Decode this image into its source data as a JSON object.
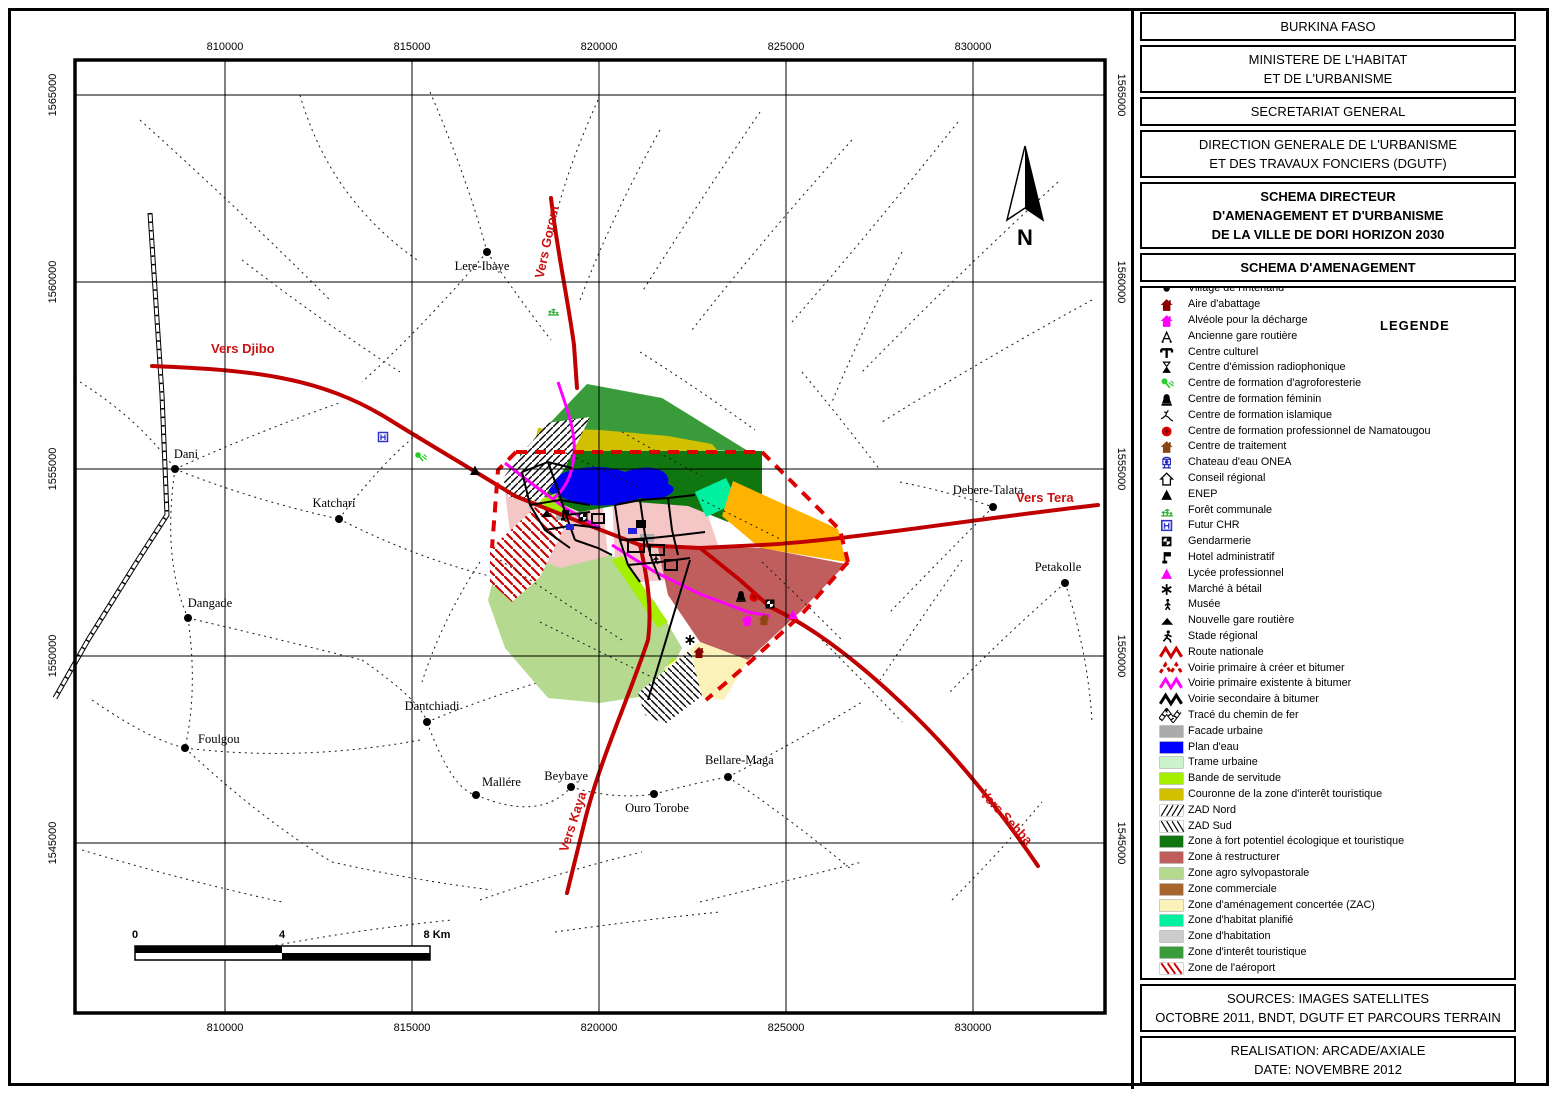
{
  "panel": {
    "boxes": [
      {
        "lines": [
          "BURKINA FASO"
        ],
        "bold": false
      },
      {
        "lines": [
          "MINISTERE DE L'HABITAT",
          "ET DE L'URBANISME"
        ],
        "bold": false
      },
      {
        "lines": [
          "SECRETARIAT GENERAL"
        ],
        "bold": false
      },
      {
        "lines": [
          "DIRECTION GENERALE DE L'URBANISME",
          "ET DES TRAVAUX FONCIERS (DGUTF)"
        ],
        "bold": false
      },
      {
        "lines": [
          "SCHEMA DIRECTEUR",
          "D'AMENAGEMENT ET D'URBANISME",
          "DE LA VILLE DE DORI HORIZON 2030"
        ],
        "bold": true
      },
      {
        "lines": [
          "SCHEMA D'AMENAGEMENT"
        ],
        "bold": true
      }
    ],
    "legend": {
      "title": "LEGENDE",
      "items": [
        {
          "label": "Village de l'interland",
          "icon": "village-dot-icon",
          "color": "#000000"
        },
        {
          "label": "Aire d'abattage",
          "icon": "house-icon",
          "color": "#8B0000"
        },
        {
          "label": "Alvéole pour la décharge",
          "icon": "house-icon",
          "color": "#FF00FF"
        },
        {
          "label": "Ancienne gare routière",
          "icon": "old-station-icon",
          "color": "#000000"
        },
        {
          "label": "Centre culturel",
          "icon": "cultural-center-icon",
          "color": "#000000"
        },
        {
          "label": "Centre d'émission radiophonique",
          "icon": "radio-tower-icon",
          "color": "#000000"
        },
        {
          "label": "Centre de formation d'agroforesterie",
          "icon": "agroforestry-icon",
          "color": "#2ECC2E"
        },
        {
          "label": "Centre de formation féminin",
          "icon": "bell-icon",
          "color": "#000000"
        },
        {
          "label": "Centre de formation islamique",
          "icon": "islamic-figure-icon",
          "color": "#000000"
        },
        {
          "label": "Centre de formation professionnel de Namatougou",
          "icon": "red-circle-icon",
          "color": "#E00000"
        },
        {
          "label": "Centre de traitement",
          "icon": "house-icon",
          "color": "#8B4513"
        },
        {
          "label": "Chateau d'eau ONEA",
          "icon": "water-tower-icon",
          "color": "#2222BB"
        },
        {
          "label": "Conseil régional",
          "icon": "house-outline-icon",
          "color": "#000000"
        },
        {
          "label": "ENEP",
          "icon": "triangle-icon",
          "color": "#000000"
        },
        {
          "label": "Forêt communale",
          "icon": "forest-icon",
          "color": "#2EAA2E"
        },
        {
          "label": "Futur CHR",
          "icon": "boxed-h-icon",
          "color": "#3333CC"
        },
        {
          "label": "Gendarmerie",
          "icon": "gendarmerie-icon",
          "color": "#000000"
        },
        {
          "label": "Hotel administratif",
          "icon": "flag-icon",
          "color": "#000000"
        },
        {
          "label": "Lycée professionnel",
          "icon": "triangle-icon",
          "color": "#FF00FF"
        },
        {
          "label": "Marché à bétail",
          "icon": "asterisk-icon",
          "color": "#000000"
        },
        {
          "label": "Musée",
          "icon": "museum-icon",
          "color": "#000000"
        },
        {
          "label": "Nouvelle gare routière",
          "icon": "flat-triangle-icon",
          "color": "#000000"
        },
        {
          "label": "Stade régional",
          "icon": "runner-icon",
          "color": "#000000"
        },
        {
          "label": "Route nationale",
          "icon": "zigzag-icon",
          "color": "#CC0000",
          "line_style": "solid"
        },
        {
          "label": "Voirie primaire à créer et bitumer",
          "icon": "zigzag-icon",
          "color": "#CC0000",
          "line_style": "dashed"
        },
        {
          "label": "Voirie primaire existente à bitumer",
          "icon": "zigzag-icon",
          "color": "#FF00FF",
          "line_style": "solid"
        },
        {
          "label": "Voirie secondaire à bitumer",
          "icon": "zigzag-icon",
          "color": "#000000",
          "line_style": "solid"
        },
        {
          "label": "Tracé du chemin de fer",
          "icon": "railway-icon",
          "color": "#000000"
        },
        {
          "label": "Facade urbaine",
          "icon": "swatch",
          "color": "#ABABAB"
        },
        {
          "label": "Plan d'eau",
          "icon": "swatch",
          "color": "#0000FF"
        },
        {
          "label": "Trame urbaine",
          "icon": "swatch",
          "color": "#CCF2CC"
        },
        {
          "label": "Bande de servitude",
          "icon": "swatch",
          "color": "#A4F000"
        },
        {
          "label": "Couronne de la zone d'interêt touristique",
          "icon": "swatch",
          "color": "#D0C000"
        },
        {
          "label": "ZAD Nord",
          "icon": "hatch-fwd",
          "color": "#000000"
        },
        {
          "label": "ZAD Sud",
          "icon": "hatch-bwd",
          "color": "#000000"
        },
        {
          "label": "Zone à fort potentiel écologique et touristique",
          "icon": "swatch",
          "color": "#107710"
        },
        {
          "label": "Zone à restructurer",
          "icon": "swatch",
          "color": "#C05E5E"
        },
        {
          "label": "Zone agro sylvopastorale",
          "icon": "swatch",
          "color": "#B5D98F"
        },
        {
          "label": "Zone commerciale",
          "icon": "swatch",
          "color": "#A8662E"
        },
        {
          "label": "Zone d'aménagement concertée (ZAC)",
          "icon": "swatch",
          "color": "#FAF2B8"
        },
        {
          "label": "Zone d'habitat planifié",
          "icon": "swatch",
          "color": "#00F0A0"
        },
        {
          "label": "Zone d'habitation",
          "icon": "swatch",
          "color": "#CCCCCC"
        },
        {
          "label": "Zone d'interêt touristique",
          "icon": "swatch",
          "color": "#3A9B3A"
        },
        {
          "label": "Zone de l'aéroport",
          "icon": "hatch-red",
          "color": "#CC0000"
        },
        {
          "label": "Zone de promotion immobilière",
          "icon": "swatch",
          "color": "#FFB300"
        }
      ]
    },
    "sources": {
      "lines": [
        "SOURCES: IMAGES SATELLITES",
        "OCTOBRE 2011, BNDT, DGUTF ET PARCOURS TERRAIN"
      ]
    },
    "realisation": {
      "lines": [
        "REALISATION: ARCADE/AXIALE",
        "DATE: NOVEMBRE 2012"
      ]
    }
  },
  "map": {
    "north_label": "N",
    "scale": {
      "zero": "0",
      "mid": "4",
      "end": "8 Km"
    },
    "x_ticks": [
      "810000",
      "815000",
      "820000",
      "825000",
      "830000"
    ],
    "y_ticks": [
      "1565000",
      "1560000",
      "1555000",
      "1550000",
      "1545000"
    ],
    "x_tick_px": [
      225,
      412,
      599,
      786,
      973
    ],
    "y_tick_px": [
      95,
      282,
      469,
      656,
      843
    ],
    "road_labels": [
      {
        "text": "Vers Djibo",
        "x": 211,
        "y": 353,
        "rot": 0,
        "anchor": "start"
      },
      {
        "text": "Vers Gorom",
        "x": 551,
        "y": 243,
        "rot": -78,
        "anchor": "middle"
      },
      {
        "text": "Vers Tera",
        "x": 1016,
        "y": 502,
        "rot": 0,
        "anchor": "start"
      },
      {
        "text": "Vers Kaya",
        "x": 577,
        "y": 823,
        "rot": -72,
        "anchor": "middle"
      },
      {
        "text": "Vers Sebba",
        "x": 1003,
        "y": 820,
        "rot": 47,
        "anchor": "middle"
      }
    ],
    "villages": [
      {
        "name": "Lere-Ibaye",
        "x": 487,
        "y": 252,
        "lx": 482,
        "ly": 270,
        "anchor": "middle"
      },
      {
        "name": "Dani",
        "x": 175,
        "y": 469,
        "lx": 186,
        "ly": 458,
        "anchor": "middle"
      },
      {
        "name": "Katchari",
        "x": 339,
        "y": 519,
        "lx": 334,
        "ly": 507,
        "anchor": "middle"
      },
      {
        "name": "Dangade",
        "x": 188,
        "y": 618,
        "lx": 210,
        "ly": 607,
        "anchor": "middle"
      },
      {
        "name": "Foulgou",
        "x": 185,
        "y": 748,
        "lx": 198,
        "ly": 743,
        "anchor": "start"
      },
      {
        "name": "Dantchiadi",
        "x": 427,
        "y": 722,
        "lx": 432,
        "ly": 710,
        "anchor": "middle"
      },
      {
        "name": "Mallére",
        "x": 476,
        "y": 795,
        "lx": 482,
        "ly": 786,
        "anchor": "start"
      },
      {
        "name": "Beybaye",
        "x": 571,
        "y": 787,
        "lx": 588,
        "ly": 780,
        "anchor": "end"
      },
      {
        "name": "Ouro Torobe",
        "x": 654,
        "y": 794,
        "lx": 657,
        "ly": 812,
        "anchor": "middle"
      },
      {
        "name": "Bellare-Maga",
        "x": 728,
        "y": 777,
        "lx": 705,
        "ly": 764,
        "anchor": "start"
      },
      {
        "name": "Debere-Talata",
        "x": 993,
        "y": 507,
        "lx": 988,
        "ly": 494,
        "anchor": "middle"
      },
      {
        "name": "Petakolle",
        "x": 1065,
        "y": 583,
        "lx": 1058,
        "ly": 571,
        "anchor": "middle"
      }
    ],
    "map_icons": [
      {
        "icon": "boxed-h-icon",
        "color": "#3333CC",
        "x": 376,
        "y": 430
      },
      {
        "icon": "agroforestry-icon",
        "color": "#22CC22",
        "x": 413,
        "y": 450
      },
      {
        "icon": "triangle-icon",
        "color": "#000000",
        "x": 468,
        "y": 463
      },
      {
        "icon": "forest-icon",
        "color": "#2EAA2E",
        "x": 546,
        "y": 303
      },
      {
        "icon": "flat-triangle-icon",
        "color": "#000000",
        "x": 539,
        "y": 506
      },
      {
        "icon": "flag-icon",
        "color": "#000000",
        "x": 558,
        "y": 508
      },
      {
        "icon": "gendarmerie-icon",
        "color": "#000000",
        "x": 576,
        "y": 510
      },
      {
        "icon": "bell-icon",
        "color": "#000000",
        "x": 734,
        "y": 589
      },
      {
        "icon": "red-circle-icon",
        "color": "#E00000",
        "x": 747,
        "y": 590
      },
      {
        "icon": "gendarmerie-icon",
        "color": "#000000",
        "x": 763,
        "y": 597
      },
      {
        "icon": "triangle-icon",
        "color": "#FF00FF",
        "x": 786,
        "y": 607
      },
      {
        "icon": "house-icon",
        "color": "#FF00FF",
        "x": 740,
        "y": 613
      },
      {
        "icon": "house-icon",
        "color": "#8B4513",
        "x": 757,
        "y": 612
      },
      {
        "icon": "asterisk-icon",
        "color": "#000000",
        "x": 683,
        "y": 633
      },
      {
        "icon": "house-icon",
        "color": "#8B0000",
        "x": 692,
        "y": 645
      },
      {
        "icon": "museum-icon",
        "color": "#000000",
        "x": 648,
        "y": 552
      }
    ]
  }
}
